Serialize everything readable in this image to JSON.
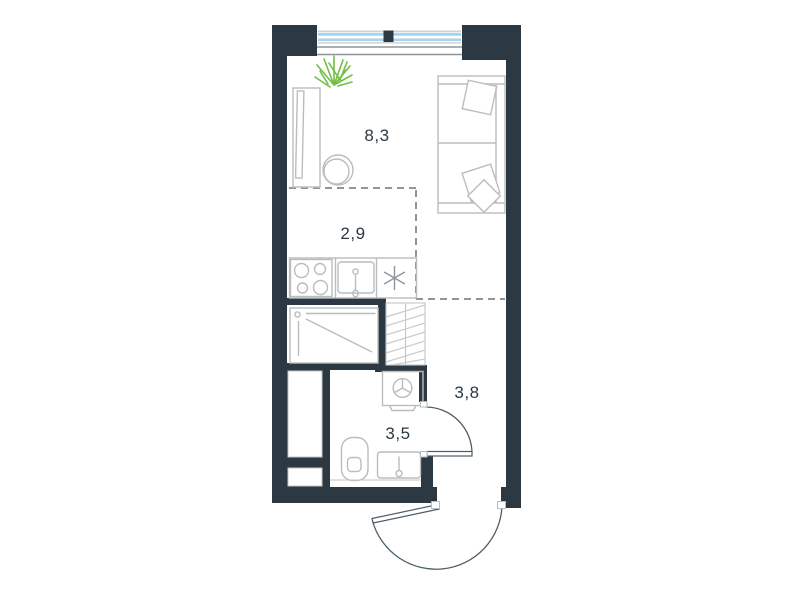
{
  "rooms": {
    "living": {
      "area": "8,3"
    },
    "kitchen": {
      "area": "2,9"
    },
    "hallway": {
      "area": "3,8"
    },
    "bathroom": {
      "area": "3,5"
    }
  },
  "fixtures": [
    "window",
    "plant",
    "wardrobe",
    "round-table",
    "sofa",
    "pillows",
    "cooktop-4-burners",
    "kitchen-sink",
    "refrigerator-asterisk",
    "ventilation-shaft",
    "shower",
    "washing-machine",
    "toilet",
    "washbasin",
    "bathroom-door",
    "entrance-door"
  ],
  "colors": {
    "wall": "#2c3942",
    "window_glass": "#a3d3ef",
    "plant": "#72bf44",
    "furniture_line": "#b9bdbf",
    "fixture_line": "#c2c6c8",
    "dashed_line": "#8f9598",
    "door_arc": "#4e5e66",
    "hatch_line": "#c9cdcf",
    "label_text": "#2c3942",
    "background": "#ffffff"
  }
}
